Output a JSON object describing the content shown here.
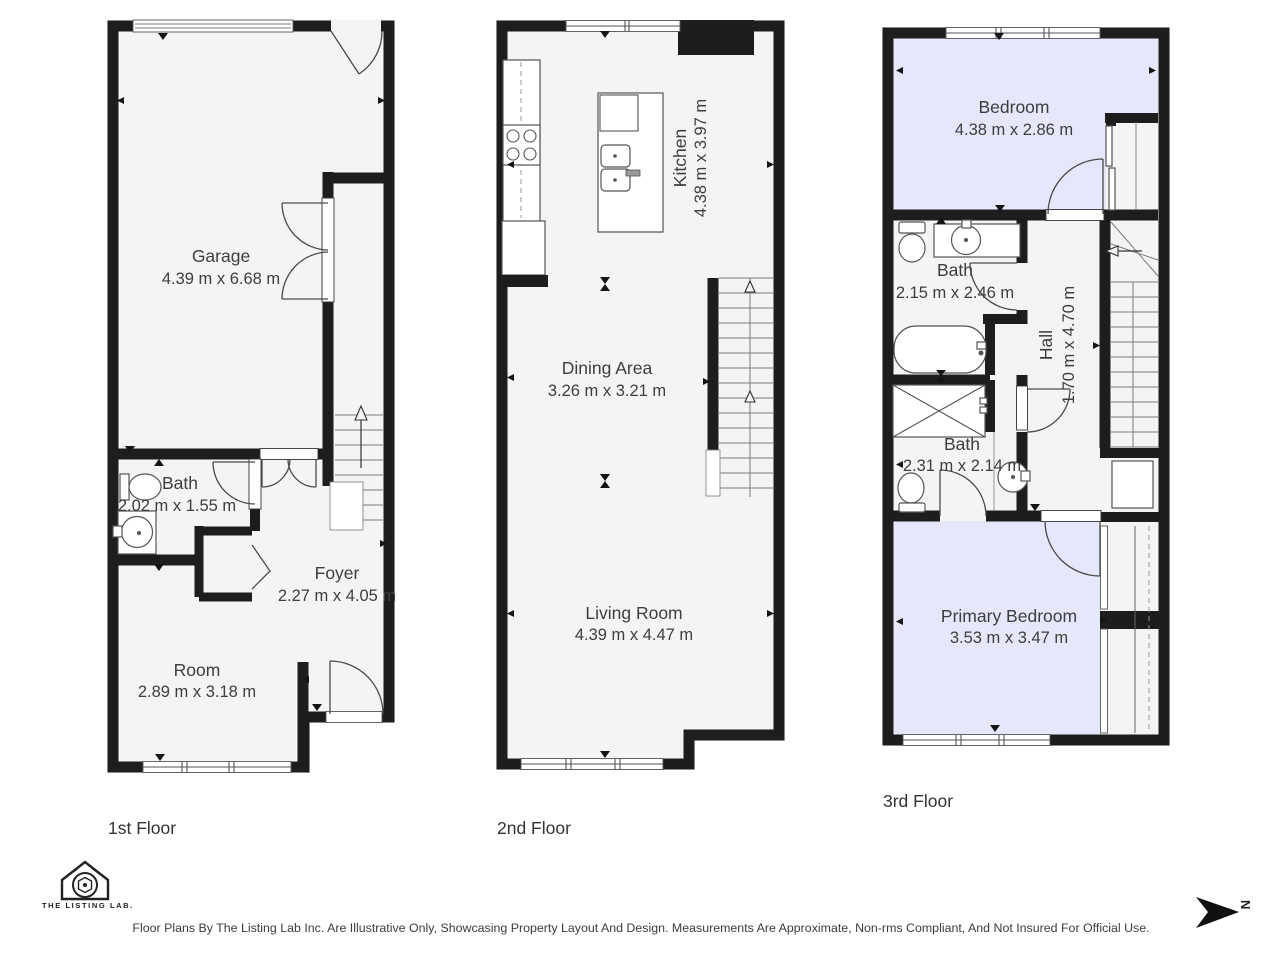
{
  "colors": {
    "wall": "#1d1d1d",
    "floor_fill": "#f5f4f2",
    "bedroom_fill": "#e4e8fa",
    "label_text": "#3e3e3e"
  },
  "floors": [
    {
      "name": "1st Floor",
      "rooms": [
        {
          "label": "Garage",
          "dims": "4.39 m x 6.68 m"
        },
        {
          "label": "Bath",
          "dims": "2.02 m x 1.55 m"
        },
        {
          "label": "Foyer",
          "dims": "2.27 m x 4.05 m"
        },
        {
          "label": "Room",
          "dims": "2.89 m x 3.18 m"
        }
      ]
    },
    {
      "name": "2nd Floor",
      "rooms": [
        {
          "label": "Kitchen",
          "dims": "4.38 m x 3.97 m"
        },
        {
          "label": "Dining Area",
          "dims": "3.26 m x 3.21 m"
        },
        {
          "label": "Living Room",
          "dims": "4.39 m x 4.47 m"
        }
      ]
    },
    {
      "name": "3rd Floor",
      "rooms": [
        {
          "label": "Bedroom",
          "dims": "4.38 m x 2.86 m"
        },
        {
          "label": "Bath",
          "dims": "2.15 m x 2.46 m"
        },
        {
          "label": "Hall",
          "dims": "1.70 m x 4.70 m"
        },
        {
          "label": "Bath",
          "dims": "2.31 m x 2.14 m"
        },
        {
          "label": "Primary Bedroom",
          "dims": "3.53 m x 3.47 m"
        }
      ]
    }
  ],
  "footer": {
    "brand": "THE LISTING LAB.",
    "disclaimer": "Floor Plans By The Listing Lab Inc. Are Illustrative Only, Showcasing Property Layout And Design. Measurements Are Approximate, Non-rms Compliant, And Not Insured For Official Use."
  },
  "compass": {
    "letter": "N"
  }
}
